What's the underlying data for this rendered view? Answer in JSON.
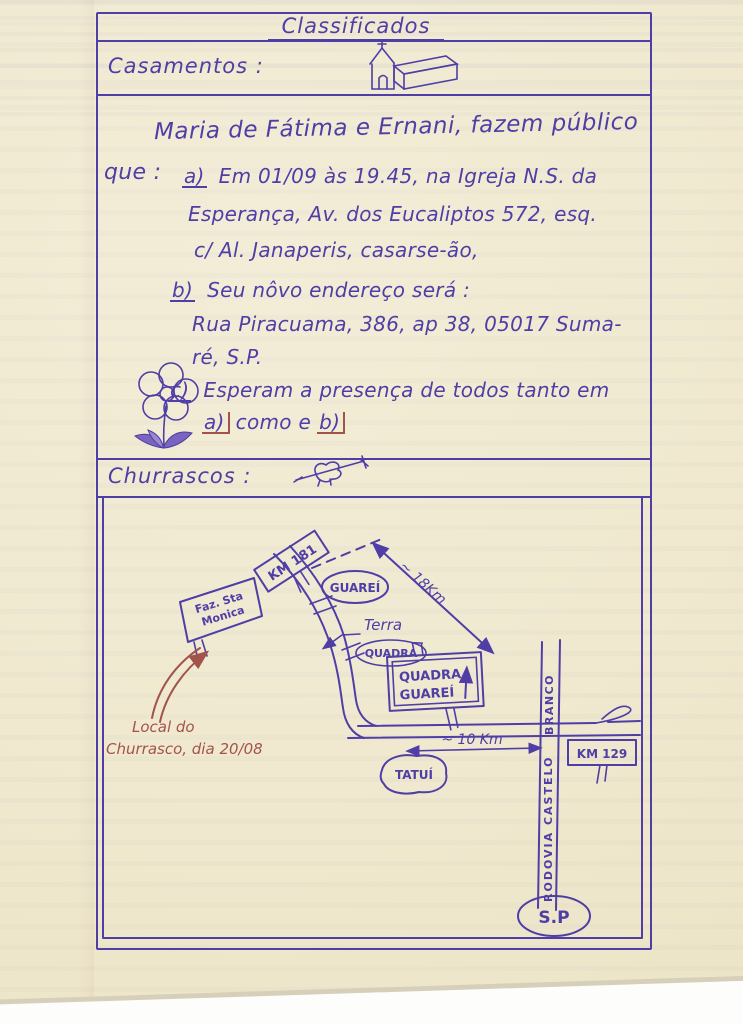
{
  "page": {
    "title": "Classificados",
    "sections": {
      "casamentos": {
        "label": "Casamentos :"
      },
      "churrascos": {
        "label": "Churrascos :"
      }
    }
  },
  "announcement": {
    "headline": "Maria de Fátima e Ernani, fazem público",
    "que_label": "que :",
    "item_a": {
      "marker": "a)",
      "line1": "Em 01/09 às 19.45, na Igreja N.S. da",
      "line2": "Esperança, Av. dos Eucaliptos 572, esq.",
      "line3": "c/ Al. Janaperis, casarse-ão,"
    },
    "item_b": {
      "marker": "b)",
      "line1": "Seu nôvo endereço será :",
      "line2": "Rua Piracuama, 386, ap 38, 05017 Suma-",
      "line3": "ré, S.P."
    },
    "item_c": {
      "marker": "c)",
      "line1": "Esperam a presença de todos tanto em"
    },
    "closing": {
      "marker_a": "a)",
      "text": "como e",
      "marker_b": "b)"
    }
  },
  "map": {
    "km181_sign": "KM 181",
    "guarei_town": "GUAREÍ",
    "distance_long": "~ 18Km",
    "farm_sign": {
      "line1": "Faz. Sta",
      "line2": "Monica"
    },
    "terra_label": "Terra",
    "quadra_oval": "QUADRA",
    "quadra_sign": {
      "line1": "QUADRA",
      "line2": "GUAREÍ"
    },
    "local_note": {
      "line1": "Local do",
      "line2": "Churrasco, dia 20/08"
    },
    "distance_short": "~ 10 Km",
    "km129_sign": "KM 129",
    "tatui_town": "TATUÍ",
    "highway": {
      "lower": "RODOVIA CASTELO",
      "upper": "BRANCO"
    },
    "sp_label": "S.P"
  },
  "icons": {
    "church": "church-doodle",
    "skewer": "barbecue-skewer-doodle",
    "flower": "flower-doodle"
  },
  "colors": {
    "ink": "#4e3ea6",
    "red_ink": "#a2544c",
    "paper": "#f0e9d0"
  }
}
